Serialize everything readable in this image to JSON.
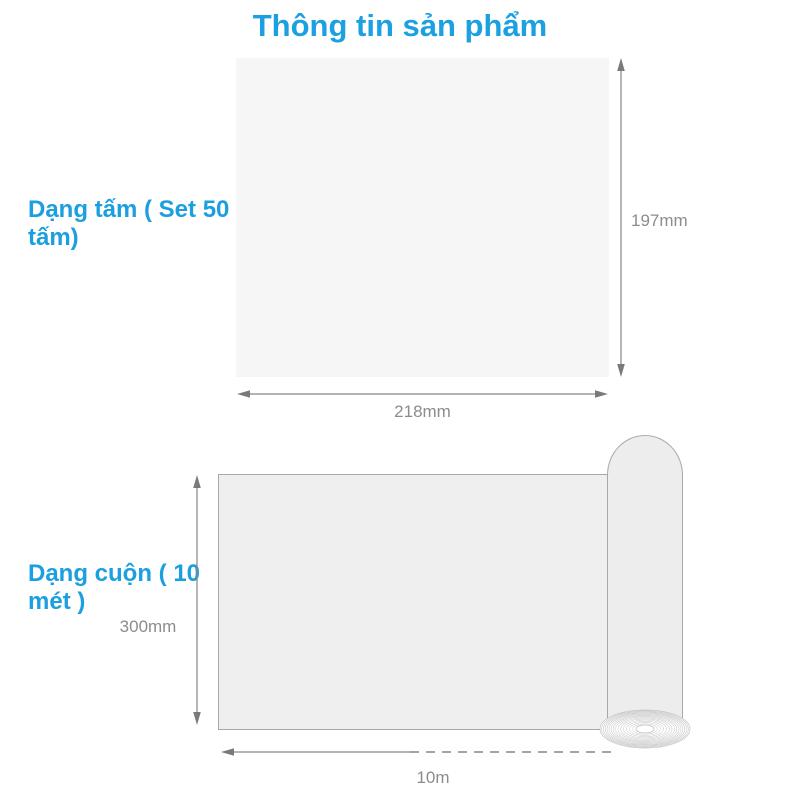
{
  "title": "Thông tin sản phẩm",
  "colors": {
    "accent_blue": "#1ba0e2",
    "dimension_gray": "#8c8c8c",
    "sheet_fill": "#f6f6f6",
    "roll_fill": "#efefef"
  },
  "sheet_section": {
    "label": "Dạng tấm ( Set 50 tấm)",
    "height": "197mm",
    "width": "218mm"
  },
  "roll_section": {
    "label": "Dạng cuộn ( 10 mét )",
    "height": "300mm",
    "length": "10m"
  }
}
